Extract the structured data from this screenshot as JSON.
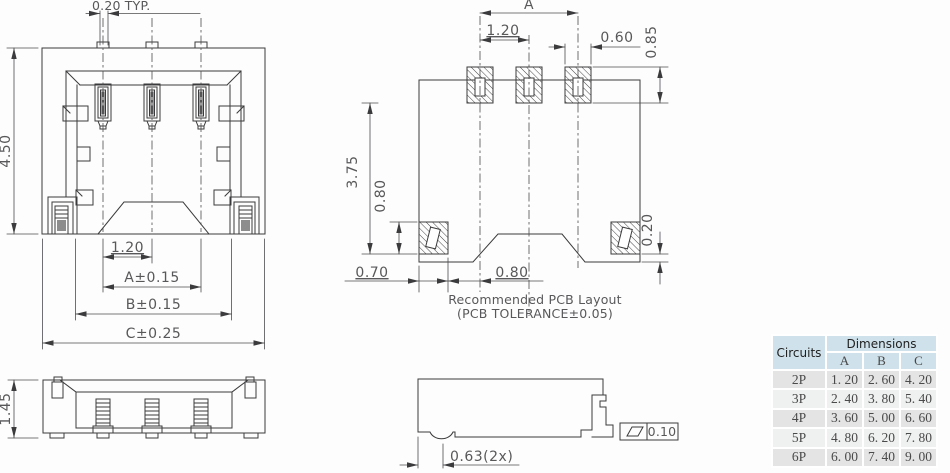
{
  "front_view": {
    "dim_pin_width": "0.20 TYP.",
    "dim_height": "4.50",
    "dim_pitch": "1.20",
    "dim_a": "A±0.15",
    "dim_b": "B±0.15",
    "dim_c": "C±0.25"
  },
  "pcb_layout": {
    "dim_span": "A",
    "dim_pitch": "1.20",
    "dim_pad_width": "0.60",
    "dim_pad_height": "0.85",
    "dim_depth": "3.75",
    "dim_side_pad_height": "0.80",
    "dim_offset": "0.20",
    "dim_edge": "0.70",
    "dim_gap": "0.80",
    "caption_line1": "Recommended PCB Layout",
    "caption_line2": "(PCB TOLERANCE±0.05)"
  },
  "side_view": {
    "dim_height": "1.45"
  },
  "profile_view": {
    "dim_foot": "0.63(2x)",
    "flatness_tolerance": "0.10"
  },
  "table": {
    "circuits_header": "Circuits",
    "dimensions_header": "Dimensions",
    "columns": [
      "A",
      "B",
      "C"
    ],
    "rows": [
      {
        "circuits": "2P",
        "a": "1. 20",
        "b": "2. 60",
        "c": "4. 20"
      },
      {
        "circuits": "3P",
        "a": "2. 40",
        "b": "3. 80",
        "c": "5. 40"
      },
      {
        "circuits": "4P",
        "a": "3. 60",
        "b": "5. 00",
        "c": "6. 60"
      },
      {
        "circuits": "5P",
        "a": "4. 80",
        "b": "6. 20",
        "c": "7. 80"
      },
      {
        "circuits": "6P",
        "a": "6. 00",
        "b": "7. 40",
        "c": "9. 00"
      }
    ]
  },
  "colors": {
    "line": "#3b3b3d",
    "dim_text": "#58585a",
    "table_header_bg": "#cfe1ea",
    "row_alt_bg": "#e4e4e4",
    "row_bg": "#eff0f0"
  }
}
